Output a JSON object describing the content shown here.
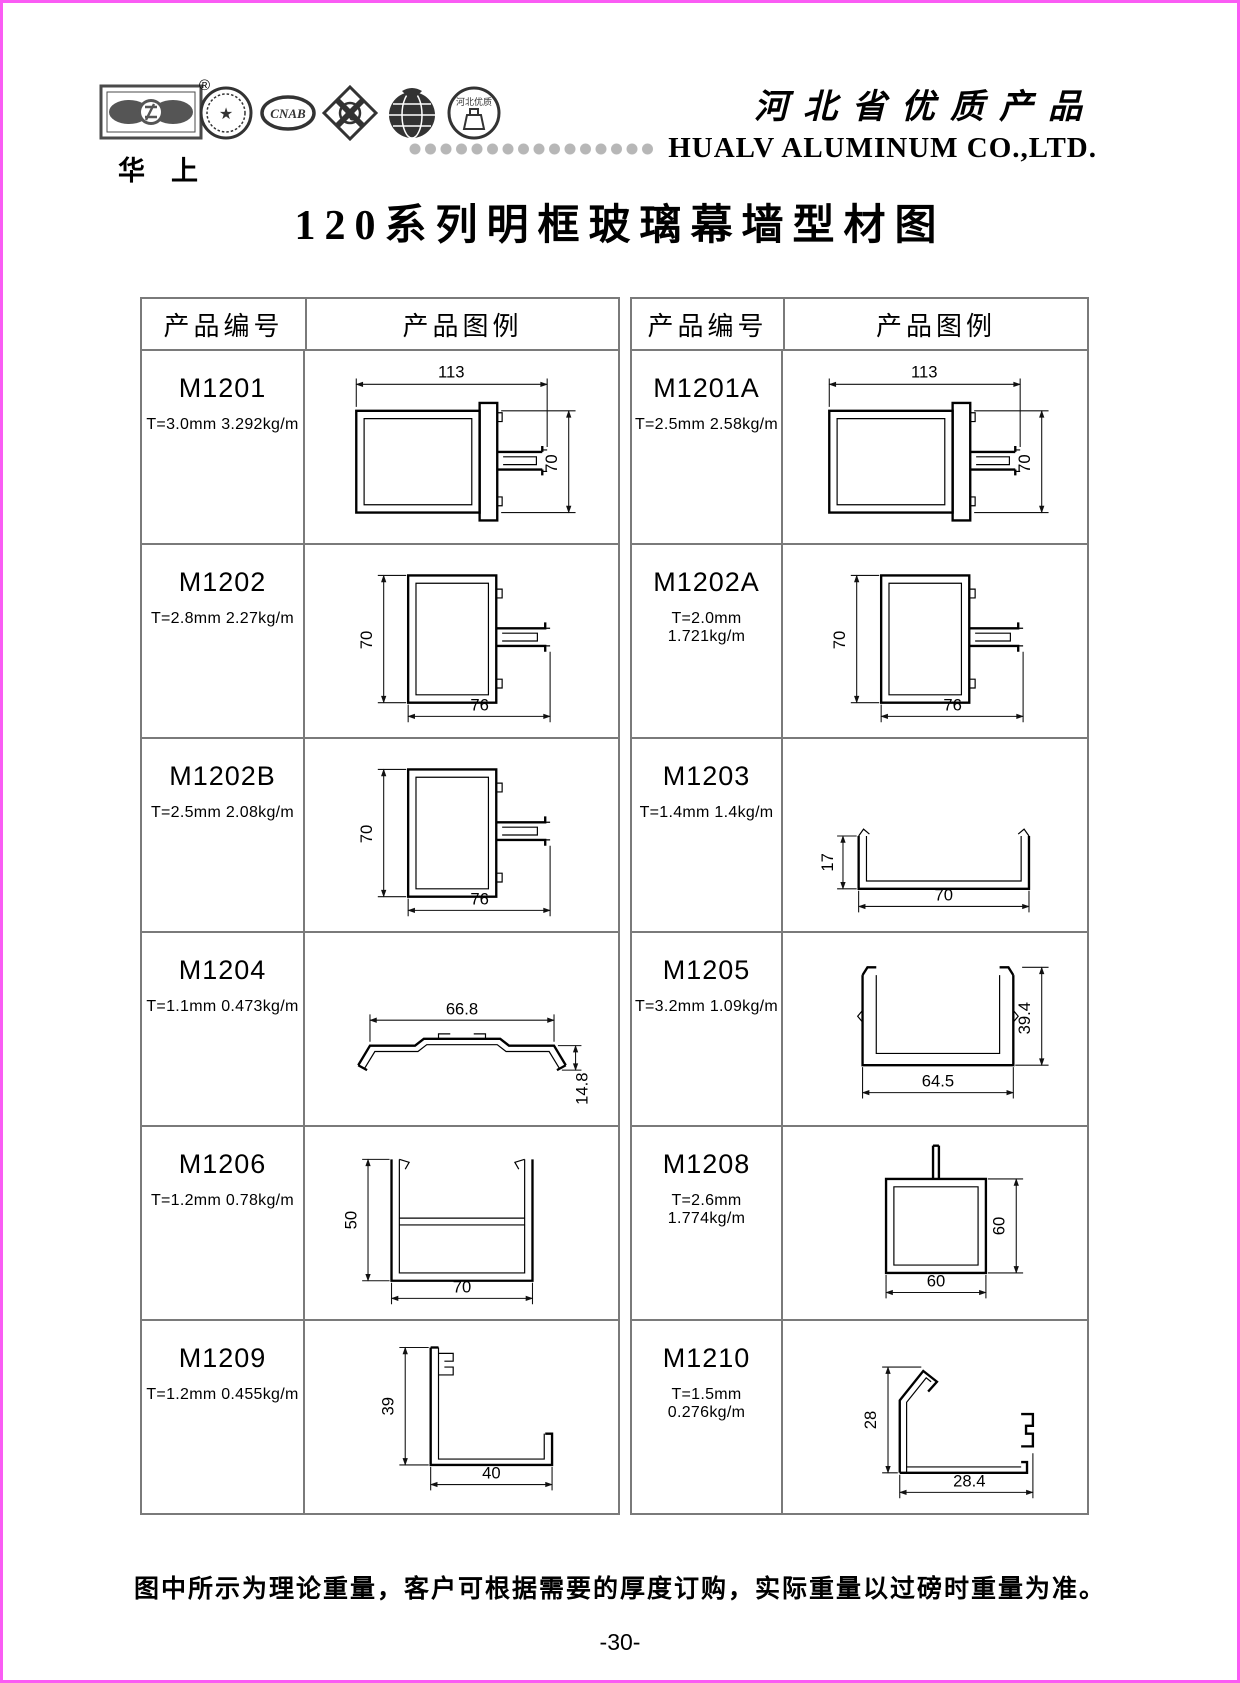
{
  "colors": {
    "page_border": "#fa5cf4",
    "table_line": "#7a7a7a",
    "dots_gray": "#b7b7b7",
    "ink": "#000000"
  },
  "header": {
    "brand_cn": "华上",
    "registered": "®",
    "slogan_cn": "河北省优质产品",
    "company_en": "HUALV ALUMINUM CO.,LTD.",
    "logos": [
      {
        "name": "hualv-eye-logo",
        "label": ""
      },
      {
        "name": "certification-seal",
        "label": "★"
      },
      {
        "name": "cnab-logo",
        "label": "CNAB"
      },
      {
        "name": "quality-clover-logo",
        "label": "Q"
      },
      {
        "name": "globe-logo",
        "label": ""
      },
      {
        "name": "hebei-quality-seal",
        "label": "河北优质"
      }
    ]
  },
  "title": "120系列明框玻璃幕墙型材图",
  "table_headers": {
    "col1": "产品编号",
    "col2": "产品图例"
  },
  "tables": [
    {
      "rows": [
        {
          "code": "M1201",
          "spec": "T=3.0mm 3.292kg/m",
          "width": "113",
          "height": "70"
        },
        {
          "code": "M1202",
          "spec": "T=2.8mm 2.27kg/m",
          "width": "76",
          "height": "70"
        },
        {
          "code": "M1202B",
          "spec": "T=2.5mm 2.08kg/m",
          "width": "76",
          "height": "70"
        },
        {
          "code": "M1204",
          "spec": "T=1.1mm 0.473kg/m",
          "width": "66.8",
          "height": "14.8"
        },
        {
          "code": "M1206",
          "spec": "T=1.2mm 0.78kg/m",
          "width": "70",
          "height": "50"
        },
        {
          "code": "M1209",
          "spec": "T=1.2mm 0.455kg/m",
          "width": "40",
          "height": "39"
        }
      ]
    },
    {
      "rows": [
        {
          "code": "M1201A",
          "spec": "T=2.5mm 2.58kg/m",
          "width": "113",
          "height": "70"
        },
        {
          "code": "M1202A",
          "spec": "T=2.0mm 1.721kg/m",
          "width": "76",
          "height": "70"
        },
        {
          "code": "M1203",
          "spec": "T=1.4mm 1.4kg/m",
          "width": "70",
          "height": "17"
        },
        {
          "code": "M1205",
          "spec": "T=3.2mm 1.09kg/m",
          "width": "64.5",
          "height": "39.4"
        },
        {
          "code": "M1208",
          "spec": "T=2.6mm 1.774kg/m",
          "width": "60",
          "height": "60"
        },
        {
          "code": "M1210",
          "spec": "T=1.5mm 0.276kg/m",
          "width": "28.4",
          "height": "28"
        }
      ]
    }
  ],
  "footer": {
    "note": "图中所示为理论重量，客户可根据需要的厚度订购，实际重量以过磅时重量为准。",
    "page_number": "-30-"
  }
}
